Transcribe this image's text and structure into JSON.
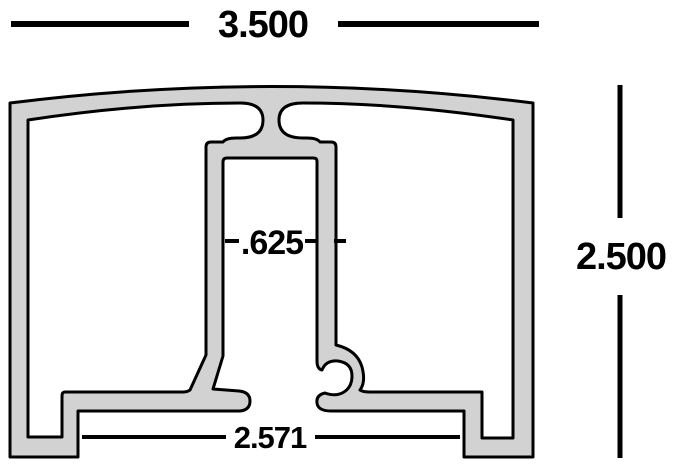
{
  "drawing": {
    "dimensions": {
      "top_width": "3.500",
      "right_height": "2.500",
      "slot_width": ".625",
      "bottom_inner_width": "2.571"
    },
    "colors": {
      "profile_fill": "#d2d2d2",
      "outline": "#000000",
      "dimension": "#000000",
      "background": "#ffffff"
    }
  }
}
